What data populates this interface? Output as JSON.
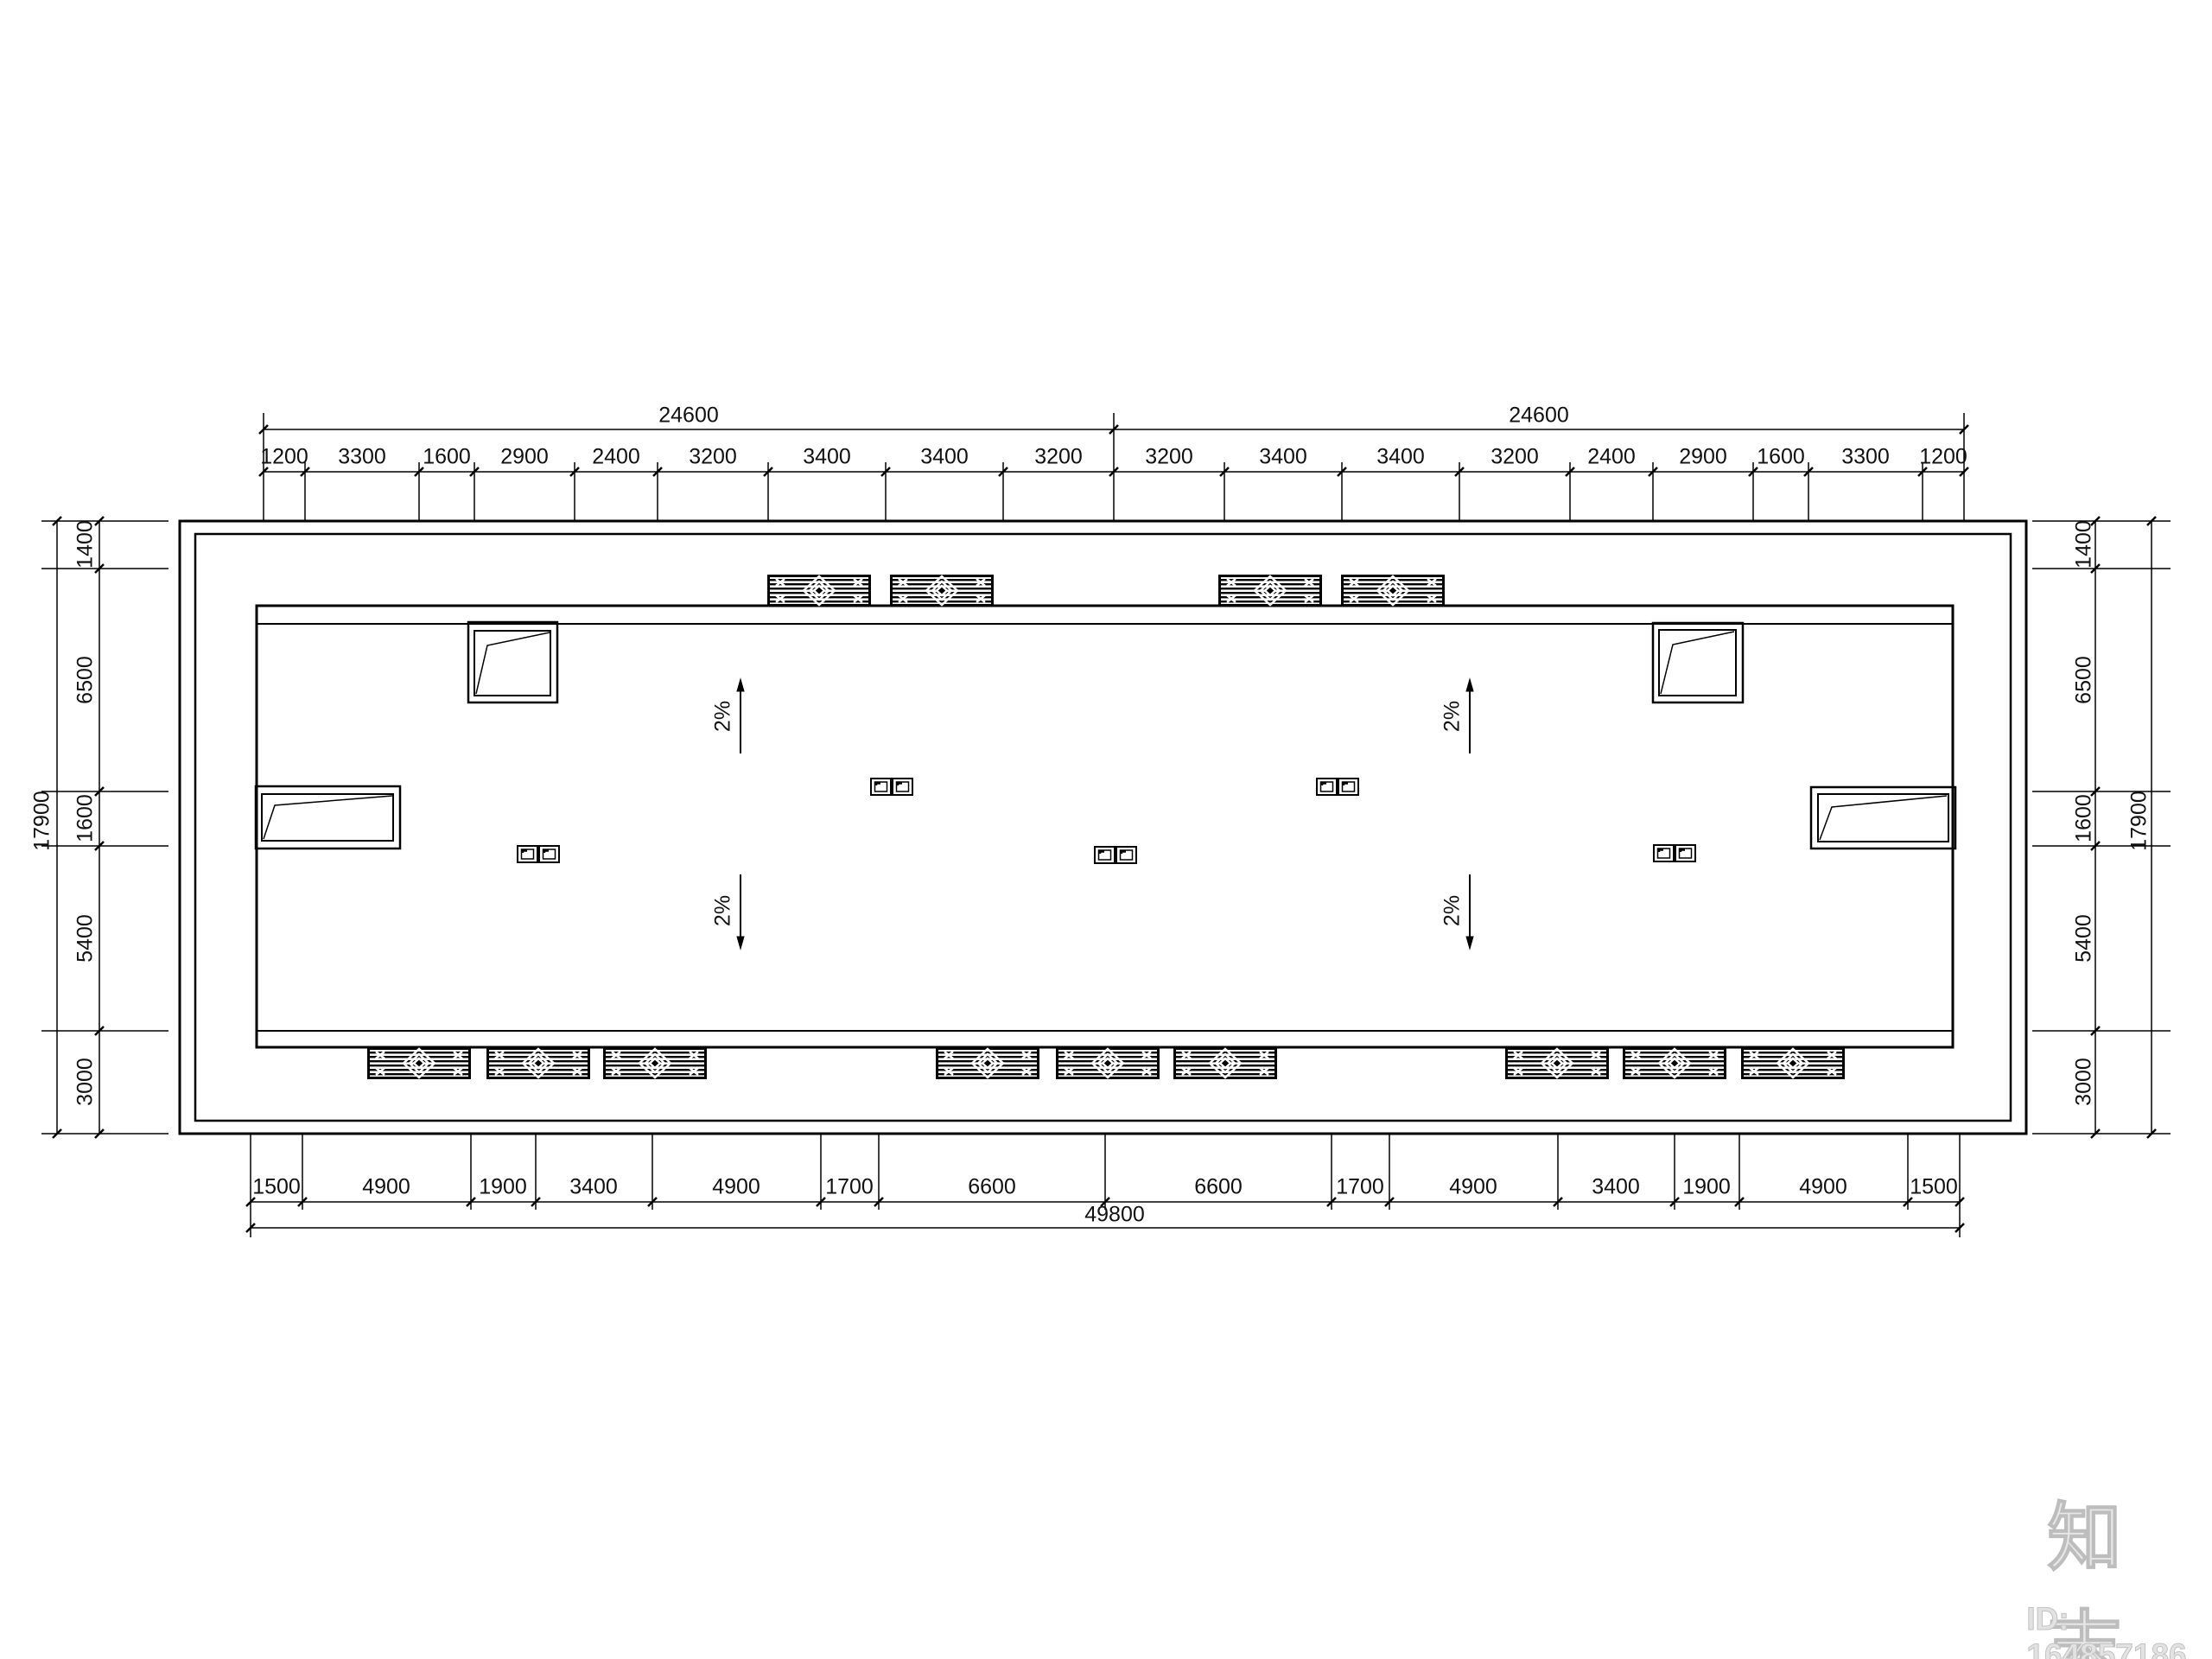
{
  "drawing": {
    "kind": "roof-plan-cad-drawing"
  },
  "dims": {
    "top_overall": [
      "24600",
      "24600"
    ],
    "top_segments": [
      "1200",
      "3300",
      "1600",
      "2900",
      "2400",
      "3200",
      "3400",
      "3400",
      "3200",
      "3200",
      "3400",
      "3400",
      "3200",
      "2400",
      "2900",
      "1600",
      "3300",
      "1200"
    ],
    "bottom_overall": "49800",
    "bottom_segments": [
      "1500",
      "4900",
      "1900",
      "3400",
      "4900",
      "1700",
      "6600",
      "6600",
      "1700",
      "4900",
      "3400",
      "1900",
      "4900",
      "1500"
    ],
    "left_overall": "17900",
    "left_segments": [
      "1400",
      "6500",
      "1600",
      "5400",
      "3000"
    ],
    "right_overall": "17900",
    "right_segments": [
      "1400",
      "6500",
      "1600",
      "5400",
      "3000"
    ]
  },
  "slopes": [
    "2%",
    "2%",
    "2%",
    "2%"
  ],
  "watermark": {
    "logo": "知末",
    "id": "ID: 164857186"
  },
  "colors": {
    "line": "#000000",
    "background": "#ffffff",
    "watermark": "#c9c9c9"
  }
}
